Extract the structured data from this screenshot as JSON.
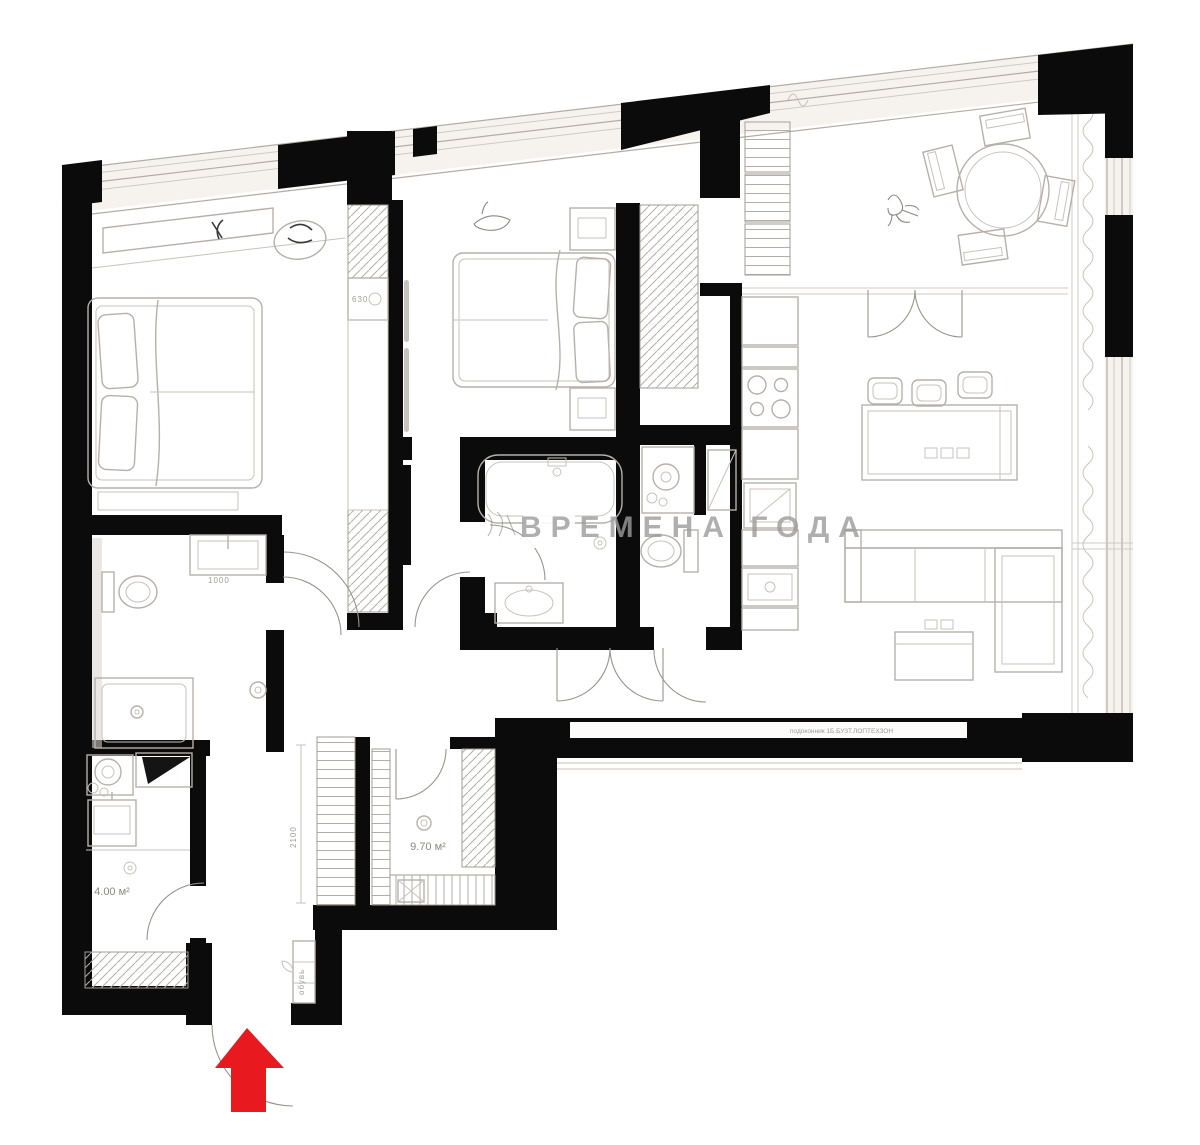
{
  "plan": {
    "type": "apartment-floor-plan",
    "watermark": "ВРЕМЕНА ГОДА",
    "entrance": {
      "arrow_color": "#e8191f",
      "direction": "up"
    },
    "colors": {
      "walls": "#0b0b0b",
      "furniture_lines": "#b7b0aa",
      "watermark": "#9c9c9c",
      "background": "#ffffff"
    },
    "labels": {
      "closet_area": "9.70 м²",
      "laundry_area": "4.00 м²",
      "dim_2100": "2100",
      "dim_630": "630",
      "dim_1000": "1000",
      "shoe_cabinet": "обувь",
      "sill_note": "подоконник 1Б.БУЗТ.ЛОПТЕХЗОН"
    },
    "rooms": [
      "bedroom-1",
      "bedroom-2",
      "kitchen-living-room",
      "dining-area",
      "bathroom-main",
      "wc",
      "bathroom-2",
      "laundry",
      "walk-in-closet",
      "hallway"
    ]
  }
}
